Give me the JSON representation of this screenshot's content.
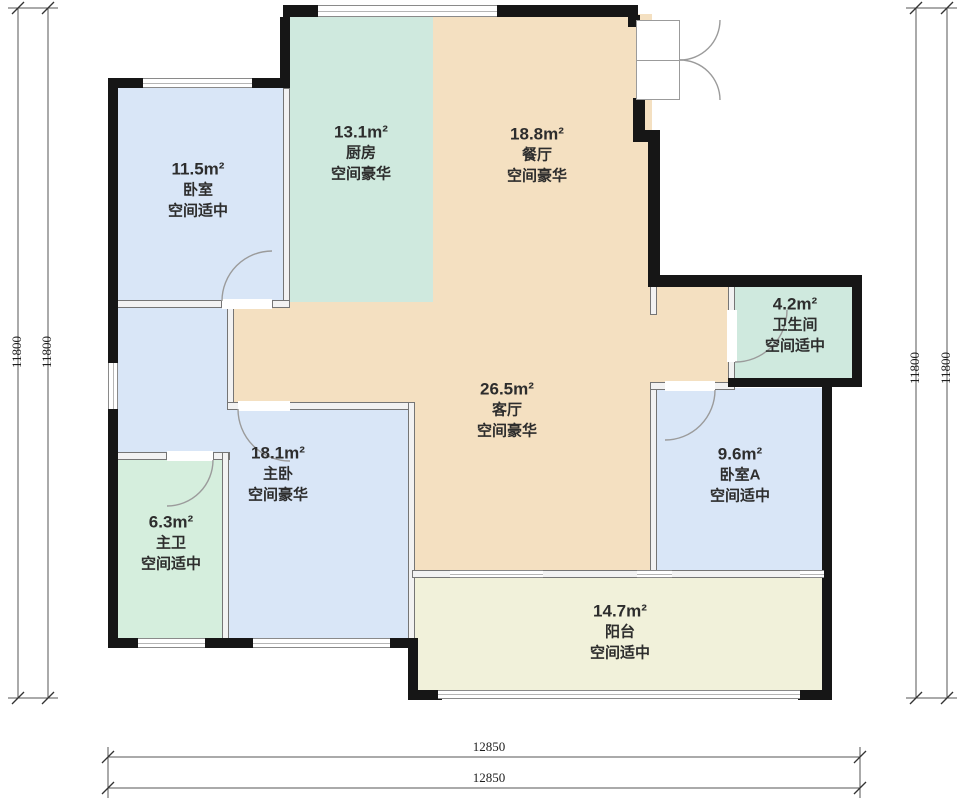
{
  "figure": {
    "kind": "apartment-floor-plan"
  },
  "plan": {
    "rooms": [
      {
        "id": "bedroom",
        "area": "11.5m²",
        "name": "卧室",
        "quality": "空间适中",
        "color": "#d9e6f7"
      },
      {
        "id": "kitchen",
        "area": "13.1m²",
        "name": "厨房",
        "quality": "空间豪华",
        "color": "#cfe9de"
      },
      {
        "id": "dining",
        "area": "18.8m²",
        "name": "餐厅",
        "quality": "空间豪华",
        "color": "#f4e0c1"
      },
      {
        "id": "bathroom",
        "area": "4.2m²",
        "name": "卫生间",
        "quality": "空间适中",
        "color": "#cfe9de"
      },
      {
        "id": "living",
        "area": "26.5m²",
        "name": "客厅",
        "quality": "空间豪华",
        "color": "#f4e0c1"
      },
      {
        "id": "master-bedroom",
        "area": "18.1m²",
        "name": "主卧",
        "quality": "空间豪华",
        "color": "#d9e6f7"
      },
      {
        "id": "master-bath",
        "area": "6.3m²",
        "name": "主卫",
        "quality": "空间适中",
        "color": "#d5eedd"
      },
      {
        "id": "bedroom-a",
        "area": "9.6m²",
        "name": "卧室A",
        "quality": "空间适中",
        "color": "#d9e6f7"
      },
      {
        "id": "balcony",
        "area": "14.7m²",
        "name": "阳台",
        "quality": "空间适中",
        "color": "#f1f1da"
      }
    ],
    "dimensions": {
      "left": [
        "11800",
        "11800"
      ],
      "right": [
        "11800",
        "11800"
      ],
      "bottom": [
        "12850",
        "12850"
      ]
    },
    "colors": {
      "exterior_wall": "#161616",
      "interior_wall": "#757575",
      "dimension_line": "#555555",
      "background": "#ffffff"
    }
  }
}
